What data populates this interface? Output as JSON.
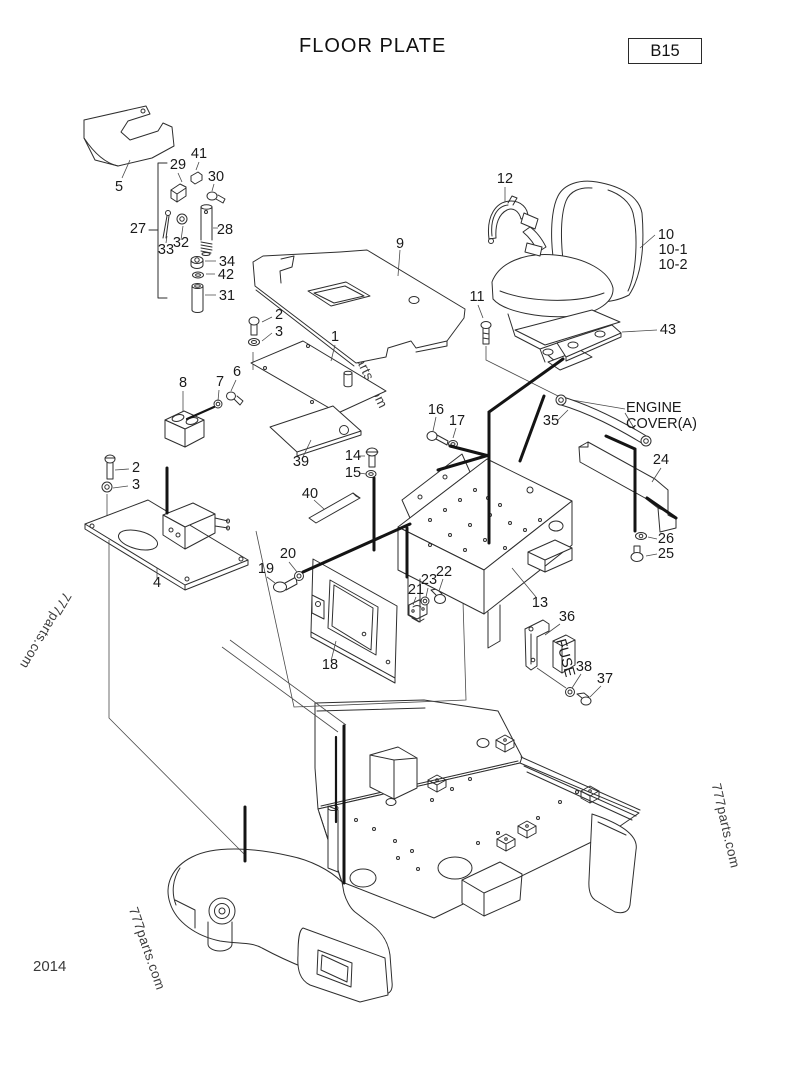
{
  "page": {
    "title": "FLOOR PLATE",
    "ref_code": "B15",
    "year": "2014",
    "watermark": "777parts.com"
  },
  "part_labels": [
    {
      "text": "5",
      "x": 119,
      "y": 191
    },
    {
      "text": "29",
      "x": 178,
      "y": 169
    },
    {
      "text": "41",
      "x": 199,
      "y": 158
    },
    {
      "text": "30",
      "x": 216,
      "y": 181
    },
    {
      "text": "27",
      "x": 138,
      "y": 233
    },
    {
      "text": "33",
      "x": 166,
      "y": 254
    },
    {
      "text": "32",
      "x": 181,
      "y": 247
    },
    {
      "text": "28",
      "x": 225,
      "y": 234
    },
    {
      "text": "34",
      "x": 227,
      "y": 266
    },
    {
      "text": "42",
      "x": 226,
      "y": 279
    },
    {
      "text": "31",
      "x": 227,
      "y": 300
    },
    {
      "text": "9",
      "x": 400,
      "y": 248
    },
    {
      "text": "12",
      "x": 505,
      "y": 183
    },
    {
      "text": "10",
      "x": 666,
      "y": 239
    },
    {
      "text": "10-1",
      "x": 673,
      "y": 254
    },
    {
      "text": "10-2",
      "x": 673,
      "y": 269
    },
    {
      "text": "11",
      "x": 477,
      "y": 301
    },
    {
      "text": "43",
      "x": 668,
      "y": 334
    },
    {
      "text": "2",
      "x": 279,
      "y": 319
    },
    {
      "text": "3",
      "x": 279,
      "y": 336
    },
    {
      "text": "1",
      "x": 335,
      "y": 341
    },
    {
      "text": "8",
      "x": 183,
      "y": 387
    },
    {
      "text": "7",
      "x": 220,
      "y": 386
    },
    {
      "text": "6",
      "x": 237,
      "y": 376
    },
    {
      "text": "16",
      "x": 436,
      "y": 414
    },
    {
      "text": "17",
      "x": 457,
      "y": 425
    },
    {
      "text": "35",
      "x": 551,
      "y": 425
    },
    {
      "text": "ENGINE",
      "x": 626,
      "y": 412,
      "anchor": "start"
    },
    {
      "text": "COVER(A)",
      "x": 626,
      "y": 428,
      "anchor": "start"
    },
    {
      "text": "24",
      "x": 661,
      "y": 464
    },
    {
      "text": "39",
      "x": 301,
      "y": 466
    },
    {
      "text": "14",
      "x": 353,
      "y": 460
    },
    {
      "text": "15",
      "x": 353,
      "y": 477
    },
    {
      "text": "40",
      "x": 310,
      "y": 498
    },
    {
      "text": "2",
      "x": 136,
      "y": 472
    },
    {
      "text": "3",
      "x": 136,
      "y": 489
    },
    {
      "text": "26",
      "x": 666,
      "y": 543
    },
    {
      "text": "25",
      "x": 666,
      "y": 558
    },
    {
      "text": "20",
      "x": 288,
      "y": 558
    },
    {
      "text": "19",
      "x": 266,
      "y": 573
    },
    {
      "text": "22",
      "x": 444,
      "y": 576
    },
    {
      "text": "23",
      "x": 429,
      "y": 584
    },
    {
      "text": "21",
      "x": 416,
      "y": 594
    },
    {
      "text": "13",
      "x": 540,
      "y": 607
    },
    {
      "text": "4",
      "x": 157,
      "y": 587
    },
    {
      "text": "36",
      "x": 567,
      "y": 621
    },
    {
      "text": "18",
      "x": 330,
      "y": 669
    },
    {
      "text": "38",
      "x": 584,
      "y": 671
    },
    {
      "text": "37",
      "x": 605,
      "y": 683
    },
    {
      "text": "FUSE",
      "x": 561,
      "y": 659,
      "size": 6.5,
      "rotate": 75
    }
  ]
}
